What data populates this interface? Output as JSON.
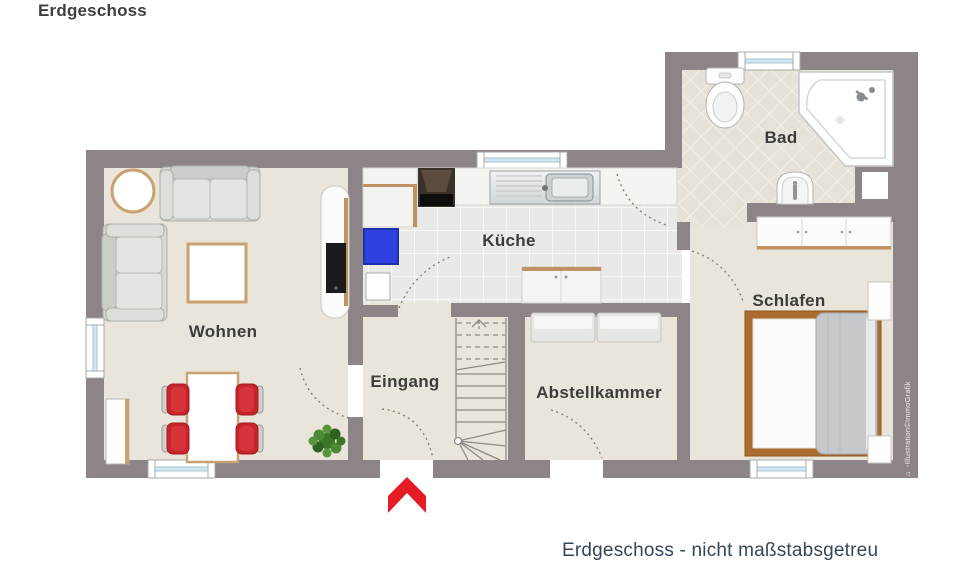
{
  "page": {
    "title": "Erdgeschoss",
    "caption": "Erdgeschoss - nicht maßstabsgetreu",
    "watermark": "-Illustration©ImmoGrafik",
    "watermark_icon": "⌂"
  },
  "rooms": {
    "wohnen": {
      "label": "Wohnen"
    },
    "kueche": {
      "label": "Küche"
    },
    "eingang": {
      "label": "Eingang"
    },
    "abstellkammer": {
      "label": "Abstellkammer"
    },
    "schlafen": {
      "label": "Schlafen"
    },
    "bad": {
      "label": "Bad"
    }
  },
  "colors": {
    "wall": "#8c8487",
    "floor_beige": "#eae5da",
    "kitchen_tile": "#e9eae7",
    "bath_tile": "#e6e2d8",
    "entrance_arrow_red": "#e51c26",
    "chair_red": "#c8242b",
    "appliance_blue": "#2e40dd",
    "wood_trim": "#bf9163",
    "label_text": "#3c3c3c",
    "caption_text": "#36465a"
  }
}
